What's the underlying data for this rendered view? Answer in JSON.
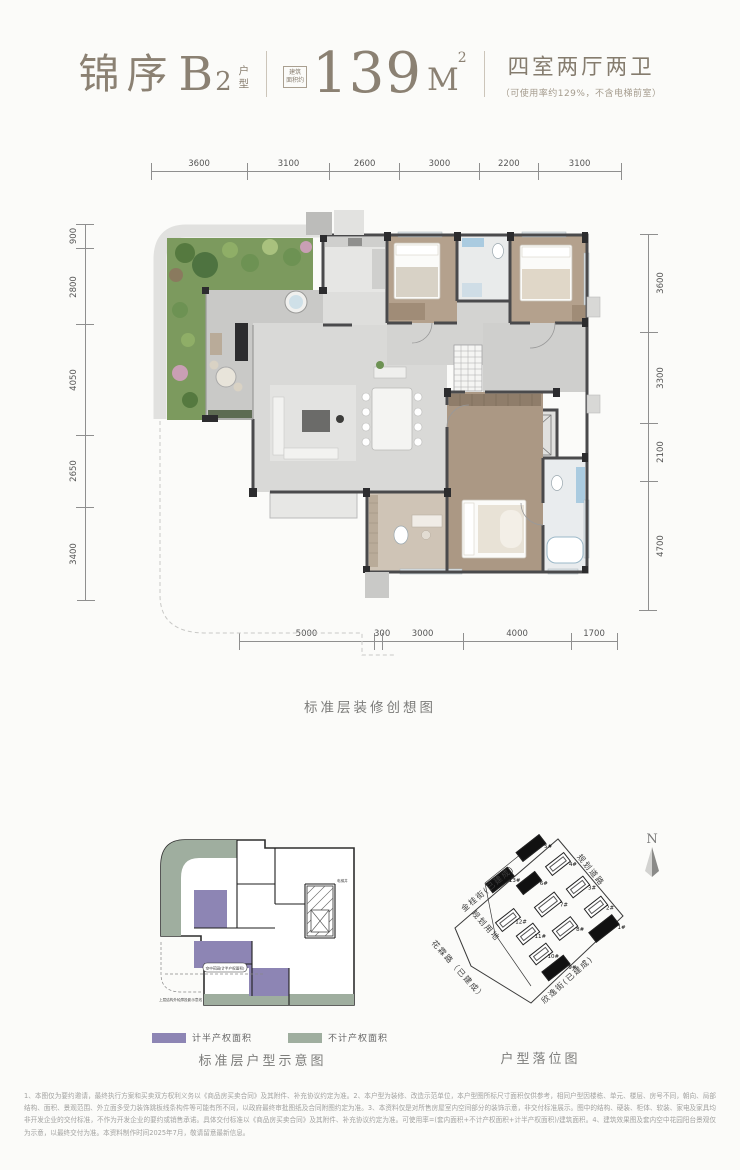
{
  "header": {
    "title_main": "锦序",
    "title_b": "B",
    "title_b_sub": "2",
    "title_stack_1": "户",
    "title_stack_2": "型",
    "area_box_1": "建筑",
    "area_box_2": "面积约",
    "area_value": "139",
    "area_unit": "M",
    "area_sup": "2",
    "rooms": "四室两厅两卫",
    "rooms_note": "（可使用率约129%，不含电梯前室）"
  },
  "floorplan": {
    "caption": "标准层装修创想图",
    "dims_top": [
      3600,
      3100,
      2600,
      3000,
      2200,
      3100
    ],
    "dims_left": [
      900,
      2800,
      4050,
      2650,
      3400
    ],
    "dims_right": [
      3600,
      3300,
      2100,
      4700
    ],
    "dims_bottom": [
      5000,
      300,
      3000,
      4000,
      1700
    ]
  },
  "schematic": {
    "caption": "标准层户型示意图",
    "legend": [
      {
        "label": "计半产权面积",
        "color": "#8d85b4"
      },
      {
        "label": "不计产权面积",
        "color": "#9fae9f"
      }
    ],
    "annotations": {
      "garden": "空中花园(计半产权面积)",
      "projection": "上层结构外轮廓投影示意线",
      "core": "电梯井"
    }
  },
  "sitemap": {
    "caption": "户型落位图",
    "compass_label": "N",
    "streets": [
      {
        "label": "金桂街(已建成)",
        "x": 26,
        "y": 80,
        "rot": -40
      },
      {
        "label": "规划道路",
        "x": 150,
        "y": 26,
        "rot": 51
      },
      {
        "label": "花霖路（已建成）",
        "x": 4,
        "y": 112,
        "rot": 48
      },
      {
        "label": "欣逸街(已建成)",
        "x": 106,
        "y": 172,
        "rot": -42
      },
      {
        "label": "规划用地",
        "x": 44,
        "y": 82,
        "rot": 48
      }
    ],
    "buildings": [
      {
        "label": "5#",
        "cx": 98,
        "cy": 22,
        "w": 30,
        "h": 12,
        "rot": -38,
        "filled": true
      },
      {
        "label": "4#",
        "cx": 125,
        "cy": 38,
        "w": 24,
        "h": 12,
        "rot": -38,
        "filled": false
      },
      {
        "label": "13#",
        "cx": 67,
        "cy": 54,
        "w": 28,
        "h": 12,
        "rot": -38,
        "filled": true
      },
      {
        "label": "6#",
        "cx": 96,
        "cy": 57,
        "w": 24,
        "h": 12,
        "rot": -38,
        "filled": true
      },
      {
        "label": "3#",
        "cx": 145,
        "cy": 61,
        "w": 22,
        "h": 12,
        "rot": -38,
        "filled": false
      },
      {
        "label": "7#",
        "cx": 115,
        "cy": 78,
        "w": 26,
        "h": 13,
        "rot": -38,
        "filled": false
      },
      {
        "label": "2#",
        "cx": 163,
        "cy": 81,
        "w": 22,
        "h": 12,
        "rot": -38,
        "filled": false
      },
      {
        "label": "12#",
        "cx": 75,
        "cy": 94,
        "w": 24,
        "h": 12,
        "rot": -38,
        "filled": false
      },
      {
        "label": "8#",
        "cx": 132,
        "cy": 102,
        "w": 24,
        "h": 13,
        "rot": -38,
        "filled": false
      },
      {
        "label": "1#",
        "cx": 171,
        "cy": 102,
        "w": 30,
        "h": 13,
        "rot": -38,
        "filled": true
      },
      {
        "label": "11#",
        "cx": 95,
        "cy": 108,
        "w": 22,
        "h": 12,
        "rot": -38,
        "filled": false
      },
      {
        "label": "10#",
        "cx": 108,
        "cy": 128,
        "w": 22,
        "h": 12,
        "rot": -38,
        "filled": false
      },
      {
        "label": "9#",
        "cx": 123,
        "cy": 142,
        "w": 28,
        "h": 12,
        "rot": -38,
        "filled": true
      }
    ]
  },
  "disclaimer": "1、本图仅为要约邀请，最终执行方案和买卖双方权利义务以《商品房买卖合同》及其附件、补充协议约定为准。2、本户型为装修、改造示范单位，本户型图所标尺寸面积仅供参考，相同户型因楼栋、单元、楼层、房号不同，朝向、局部结构、面积、景观范围、外立面多受力装饰跳板线条构件等可能有所不同，以政府最终审批图纸及合同附图约定为准。3、本资料仅是对所售房屋室内空间部分的装饰示意，非交付标准展示。图中的结构、硬装、柜体、软装、家电及家具均非开发企业的交付标准，不作为开发企业的要约或销售承诺。具体交付标准以《商品房买卖合同》及其附件、补充协议约定为准。可使用率=(套内面积+不计产权面积+计半产权面积)/建筑面积。4、建筑效果图及套内空中花园阳台景观仅为示意，以最终交付为准。本资料制作时间2025年7月，敬请留意最新信息。"
}
